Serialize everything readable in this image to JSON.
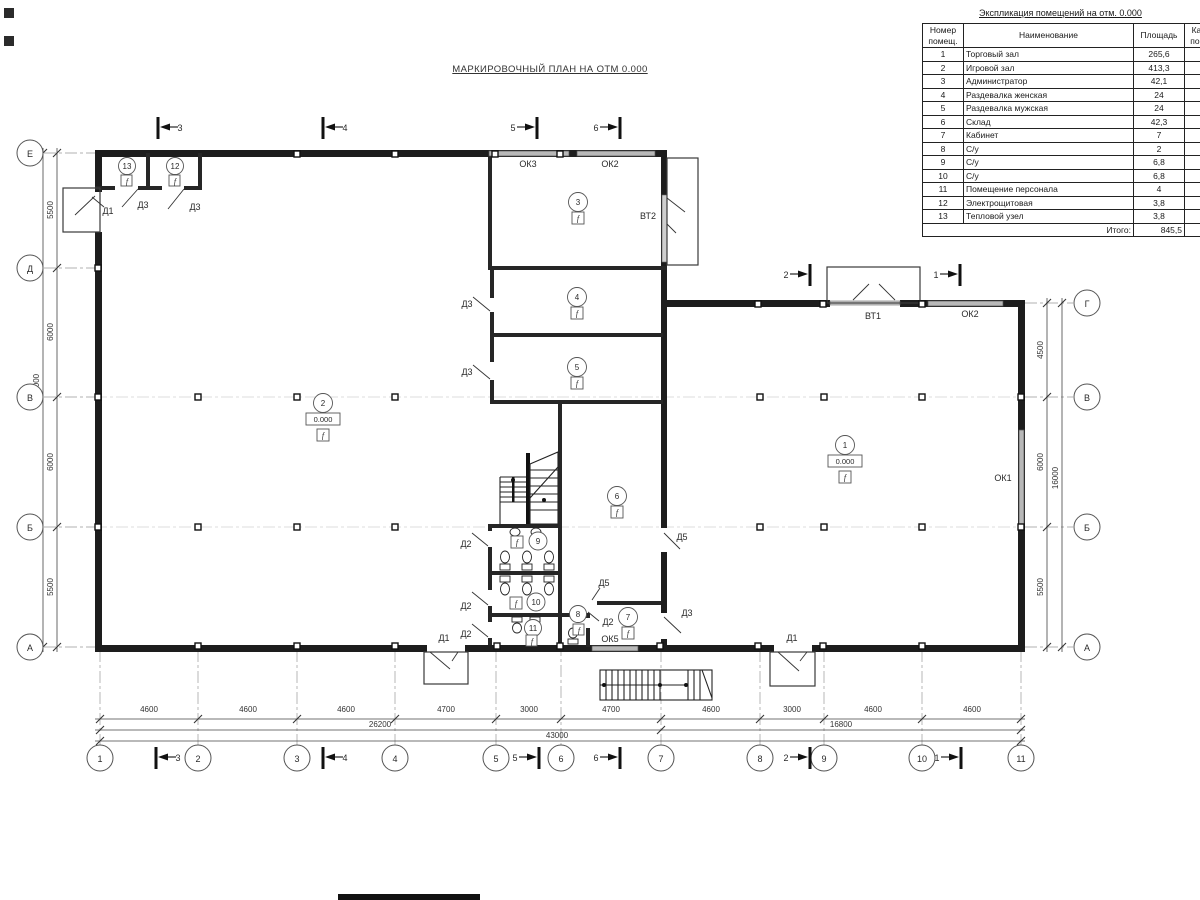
{
  "plan": {
    "title": "МАРКИРОВОЧНЫЙ ПЛАН НА ОТМ 0.000",
    "labels": {
      "d1": "Д1",
      "d2": "Д2",
      "d3": "Д3",
      "d5": "Д5",
      "ok1": "ОК1",
      "ok2": "ОК2",
      "ok3": "ОК3",
      "ok5": "ОК5",
      "vt1": "ВТ1",
      "vt2": "ВТ2",
      "elevation": "0.000",
      "floor_mark": "f"
    },
    "rooms": [
      "1",
      "2",
      "3",
      "4",
      "5",
      "6",
      "7",
      "8",
      "9",
      "10",
      "11",
      "12",
      "13"
    ],
    "axes_bottom": [
      "1",
      "2",
      "3",
      "4",
      "5",
      "6",
      "7",
      "8",
      "9",
      "10",
      "11"
    ],
    "axes_left": [
      "Е",
      "Д",
      "В",
      "Б",
      "А"
    ],
    "axes_right": [
      "Г",
      "В",
      "Б",
      "А"
    ],
    "sections": {
      "s1": "1",
      "s2": "2",
      "s3": "3",
      "s4": "4",
      "s5": "5",
      "s6": "6"
    },
    "dims_bottom": [
      "4600",
      "4600",
      "4600",
      "4700",
      "3000",
      "4700",
      "4600",
      "3000",
      "4600",
      "4600"
    ],
    "dims_bottom_sub": [
      "26200",
      "16800"
    ],
    "dim_bottom_total": "43000",
    "dims_left": [
      "5500",
      "6000",
      "6000",
      "5500"
    ],
    "dim_left_total": "23000",
    "dims_right": [
      "4500",
      "6000",
      "5500"
    ],
    "dim_right_total": "16000"
  },
  "table": {
    "title": "Экспликация помещений на отм. 0.000",
    "headers": {
      "num": "Номер помещ.",
      "name": "Наименование",
      "area": "Площадь",
      "cat": "Кат. пом."
    },
    "rows": [
      {
        "num": "1",
        "name": "Торговый зал",
        "area": "265,6",
        "cat": ""
      },
      {
        "num": "2",
        "name": "Игровой зал",
        "area": "413,3",
        "cat": ""
      },
      {
        "num": "3",
        "name": "Администратор",
        "area": "42,1",
        "cat": ""
      },
      {
        "num": "4",
        "name": "Раздевалка женская",
        "area": "24",
        "cat": ""
      },
      {
        "num": "5",
        "name": "Раздевалка мужская",
        "area": "24",
        "cat": ""
      },
      {
        "num": "6",
        "name": "Склад",
        "area": "42,3",
        "cat": ""
      },
      {
        "num": "7",
        "name": "Кабинет",
        "area": "7",
        "cat": ""
      },
      {
        "num": "8",
        "name": "С/у",
        "area": "2",
        "cat": ""
      },
      {
        "num": "9",
        "name": "С/у",
        "area": "6,8",
        "cat": ""
      },
      {
        "num": "10",
        "name": "С/у",
        "area": "6,8",
        "cat": ""
      },
      {
        "num": "11",
        "name": "Помещение персонала",
        "area": "4",
        "cat": ""
      },
      {
        "num": "12",
        "name": "Электрощитовая",
        "area": "3,8",
        "cat": ""
      },
      {
        "num": "13",
        "name": "Тепловой узел",
        "area": "3,8",
        "cat": ""
      }
    ],
    "total_label": "Итого:",
    "total_value": "845,5"
  }
}
